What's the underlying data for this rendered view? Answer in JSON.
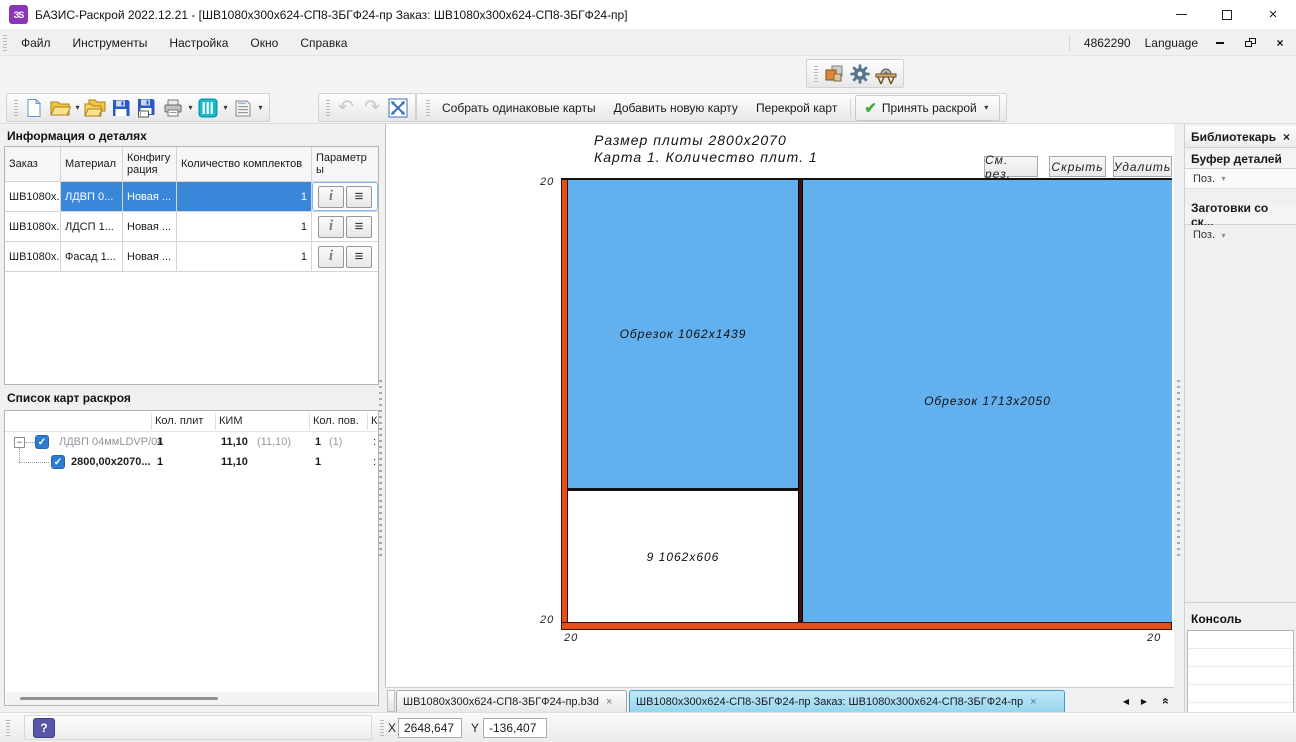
{
  "window": {
    "logo": "ЗS",
    "title": "БАЗИС-Раскрой 2022.12.21 - [ШВ1080x300x624-СП8-3БГФ24-пр Заказ: ШВ1080x300x624-СП8-3БГФ24-пр]"
  },
  "menu": {
    "items": [
      "Файл",
      "Инструменты",
      "Настройка",
      "Окно",
      "Справка"
    ],
    "counter": "4862290",
    "language": "Language"
  },
  "toolbar": {
    "collect": "Собрать одинаковые карты",
    "add": "Добавить новую карту",
    "recut": "Перекрой карт",
    "accept": "Принять раскрой"
  },
  "details_panel": {
    "title": "Информация о деталях",
    "columns": [
      "Заказ",
      "Материал",
      "Конфигурация",
      "Количество комплектов",
      "Параметры"
    ],
    "rows": [
      {
        "order": "ШВ1080x...",
        "material": "ЛДВП 0...",
        "config": "Новая ...",
        "qty": "1"
      },
      {
        "order": "ШВ1080x...",
        "material": "ЛДСП 1...",
        "config": "Новая ...",
        "qty": "1"
      },
      {
        "order": "ШВ1080x...",
        "material": "Фасад 1...",
        "config": "Новая ...",
        "qty": "1"
      }
    ]
  },
  "maps_panel": {
    "title": "Список карт раскроя",
    "columns": [
      "Кол. плит",
      "КИМ",
      "Кол. пов.",
      "К"
    ],
    "rows": [
      {
        "label": "ЛДВП 04ммLDVP/04",
        "plates": "1",
        "kim": "11,10",
        "kim2": "(11,10)",
        "pov": "1",
        "pov2": "(1)",
        "k": ":"
      },
      {
        "label": "2800,00x2070...",
        "plates": "1",
        "kim": "11,10",
        "pov": "1",
        "k": ":"
      }
    ]
  },
  "canvas": {
    "size_line": "Размер плиты  2800х2070",
    "map_line": "Карта 1. Количество плит. 1",
    "btn_rez": "См. рез.",
    "btn_hide": "Скрыть",
    "btn_del": "Удалить",
    "trim": "20",
    "regions": {
      "left_offcut": "Обрезок  1062х1439",
      "right_offcut": "Обрезок  1713х2050",
      "part": "9  1062х606"
    },
    "colors": {
      "offcut": "#63b0ef",
      "part": "#ffffff",
      "trim": "#e4501a",
      "cut": "#4a0f0b"
    }
  },
  "tabs": {
    "tab1": "ШВ1080x300x624-СП8-3БГФ24-пр.b3d",
    "tab2": "ШВ1080x300x624-СП8-3БГФ24-пр Заказ: ШВ1080x300x624-СП8-3БГФ24-пр"
  },
  "library": {
    "title": "Библиотекарь",
    "buffer_title": "Буфер деталей",
    "buffer_filter": "Поз.",
    "blanks_title": "Заготовки со ск...",
    "blanks_filter": "Поз."
  },
  "console": {
    "title": "Консоль"
  },
  "status": {
    "x_label": "X",
    "x_value": "2648,647",
    "y_label": "Y",
    "y_value": "-136,407"
  },
  "icons": {
    "dropdown": "▾",
    "check": "✓",
    "close_x": "×",
    "nav_left": "◀",
    "nav_right": "▶",
    "collapse": "«",
    "expand_minus": "−",
    "info": "i",
    "menu_lines": "≡",
    "undo": "↶",
    "redo": "↷",
    "accept_check": "✔",
    "help": "?"
  }
}
